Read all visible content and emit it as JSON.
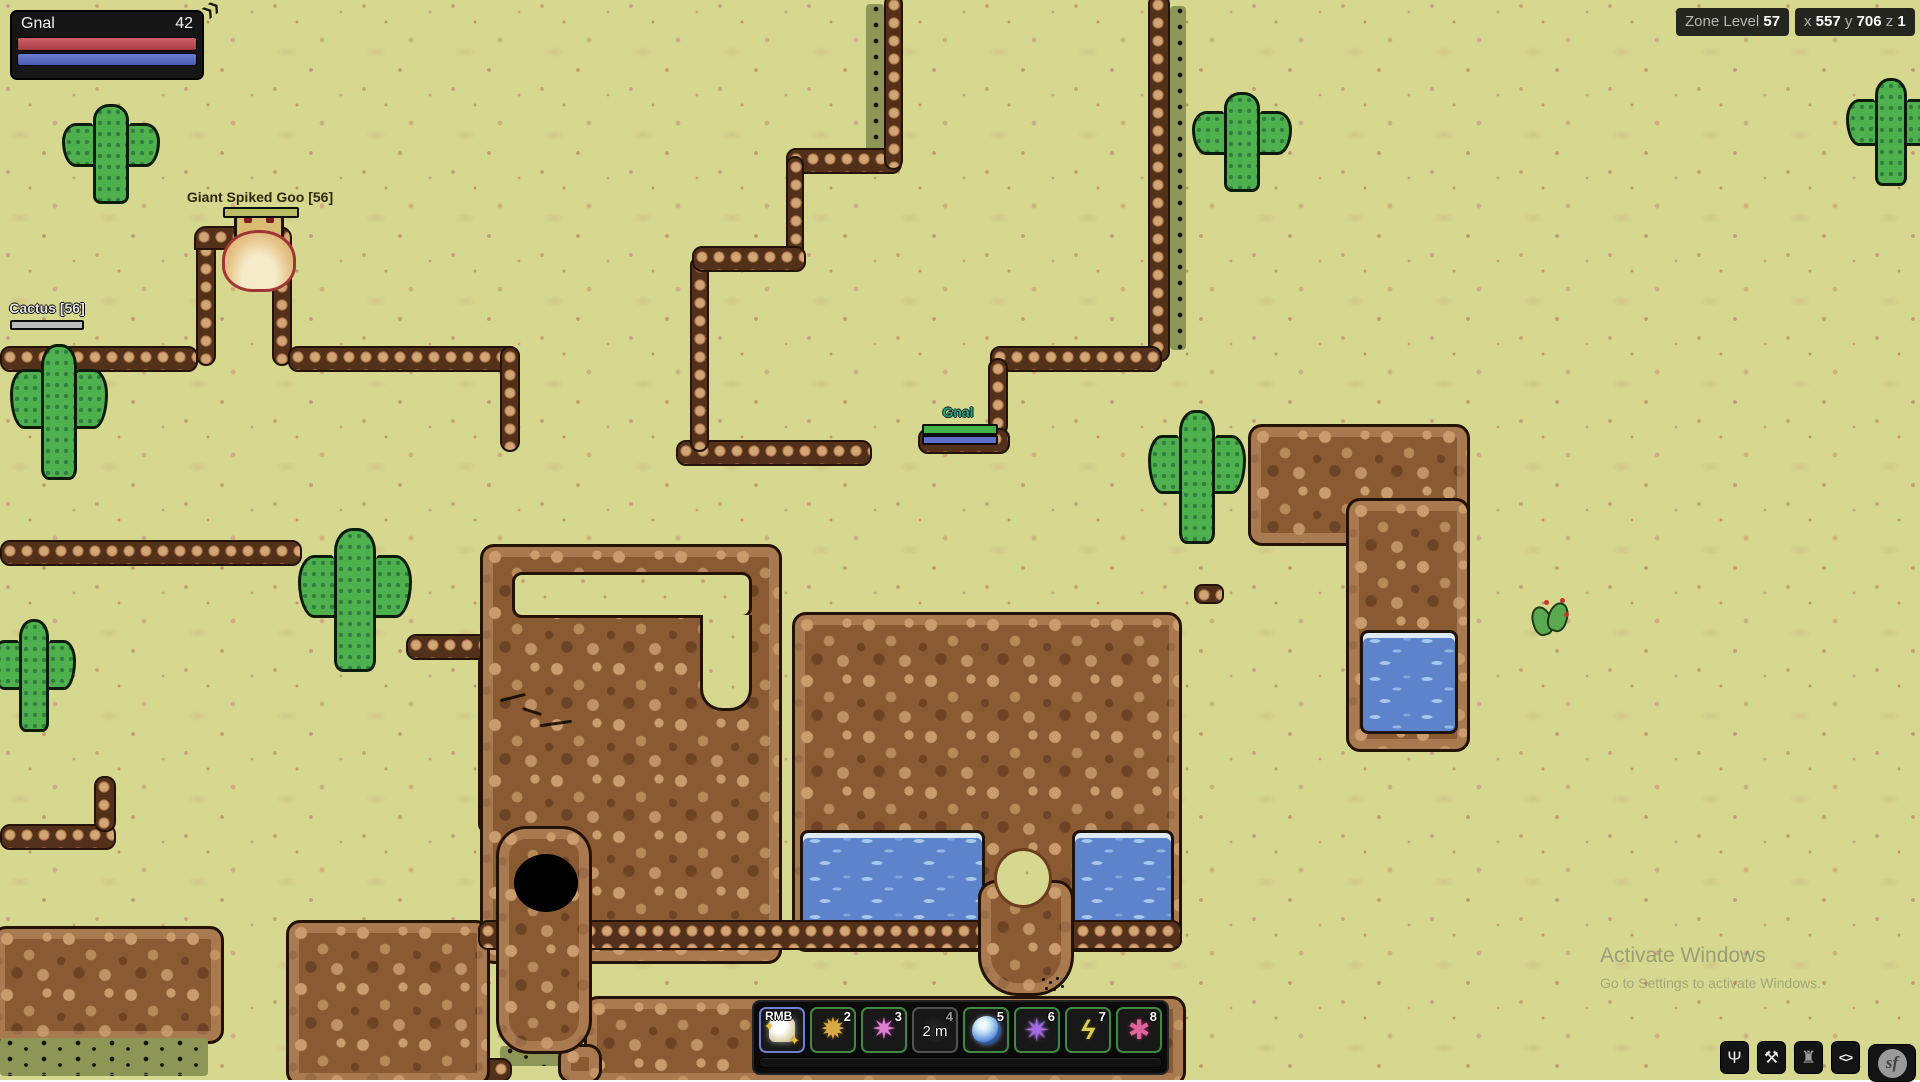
{
  "hud": {
    "player_frame": {
      "name": "Gnal",
      "value": "42",
      "chevrons": "❯❯"
    },
    "zone": {
      "label": "Zone Level",
      "value": "57"
    },
    "coords": {
      "x_label": "x",
      "x": "557",
      "y_label": "y",
      "y": "706",
      "z_label": "z",
      "z": "1"
    },
    "watermark": {
      "line1": "Activate Windows",
      "line2": "Go to Settings to activate Windows."
    }
  },
  "entities": {
    "goo": {
      "label": "Giant Spiked Goo [56]"
    },
    "cactus": {
      "label": "Cactus [56]"
    },
    "player": {
      "label": "Gnal"
    }
  },
  "hotbar": {
    "slots": [
      {
        "key": "RMB",
        "glyph": "✦"
      },
      {
        "key": "2",
        "glyph": "✹"
      },
      {
        "key": "3",
        "glyph": "✷"
      },
      {
        "key": "4",
        "cooldown": "2 m"
      },
      {
        "key": "5"
      },
      {
        "key": "6",
        "glyph": "✴"
      },
      {
        "key": "7",
        "glyph": "ϟ"
      },
      {
        "key": "8",
        "glyph": "✱"
      }
    ]
  },
  "corner_buttons": [
    {
      "name": "character",
      "glyph": "Ψ"
    },
    {
      "name": "pickaxe",
      "glyph": "⚒"
    },
    {
      "name": "creature",
      "glyph": "♜"
    },
    {
      "name": "code-brackets",
      "glyph": "<>"
    },
    {
      "name": "sf-logo",
      "glyph": "sf"
    }
  ],
  "colors": {
    "health_red": "#b94b52",
    "mana_blue": "#5b6fc8",
    "enemy_hp_yellow": "#b9bd63",
    "neutral_hp_gray": "#bcbcbc",
    "player_hp_green": "#43b347",
    "hotbar_ready_green": "#3f8a3f",
    "hotbar_selected_blue": "#7280cc",
    "sand": "#d6d88f",
    "water": "#5d84ca"
  }
}
